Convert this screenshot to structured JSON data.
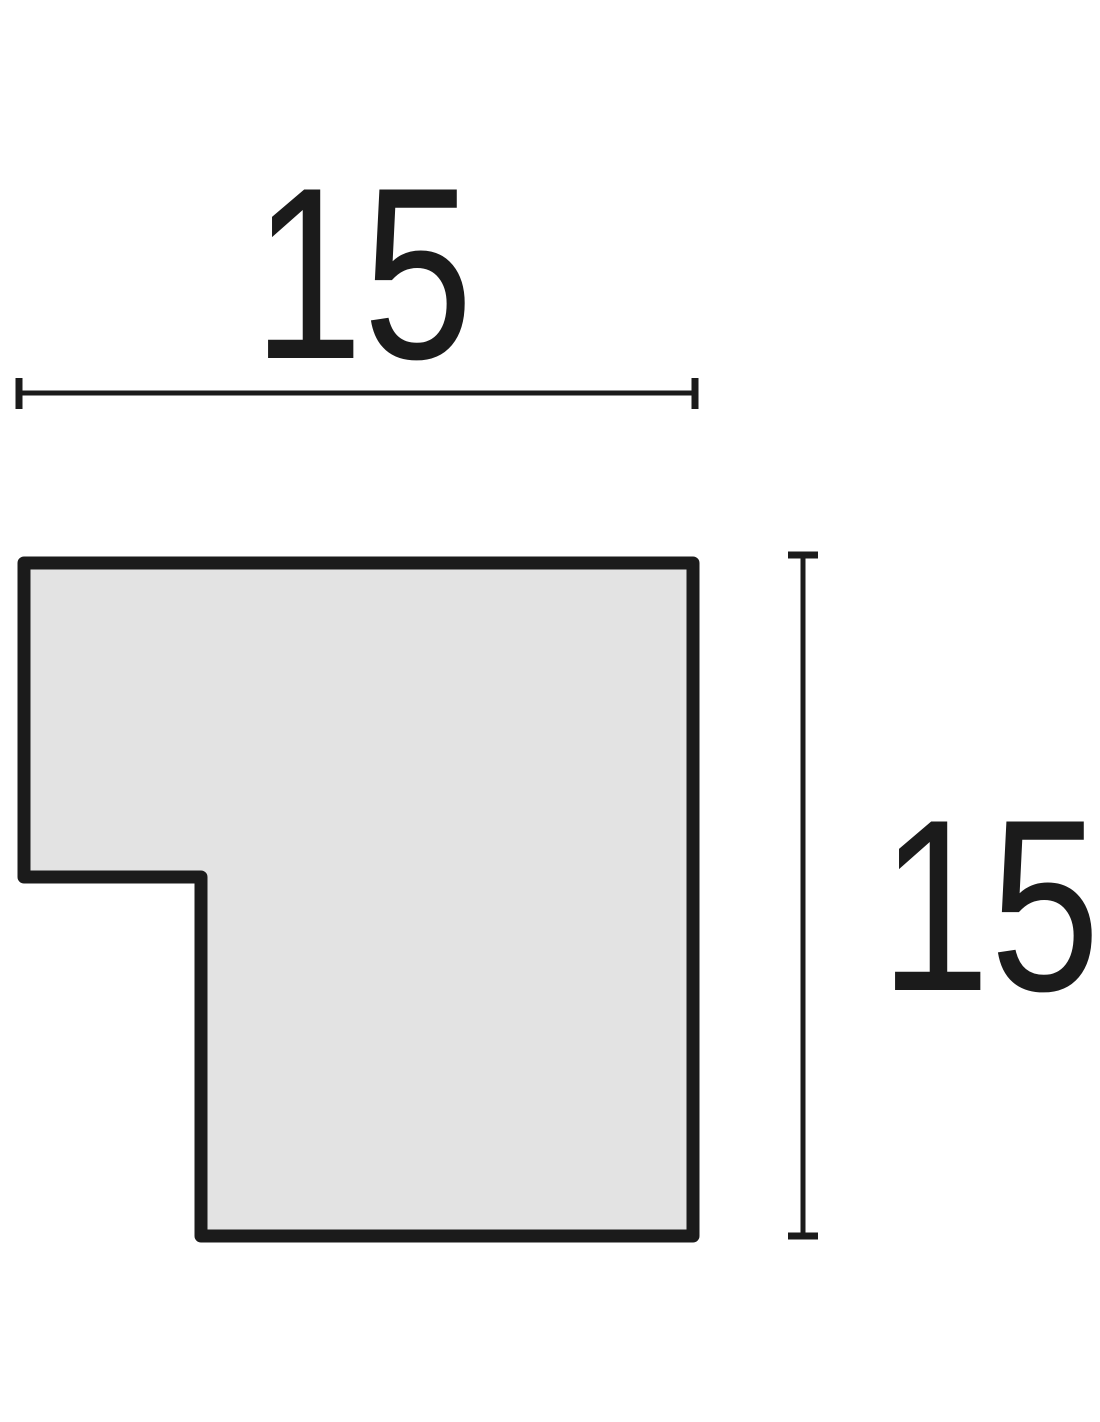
{
  "diagram": {
    "type": "moulding-profile-cross-section",
    "width_label": "15",
    "height_label": "15",
    "colors": {
      "outline": "#1b1b1b",
      "fill": "#e3e3e3",
      "dimension": "#1b1b1b",
      "background": "#ffffff"
    }
  }
}
